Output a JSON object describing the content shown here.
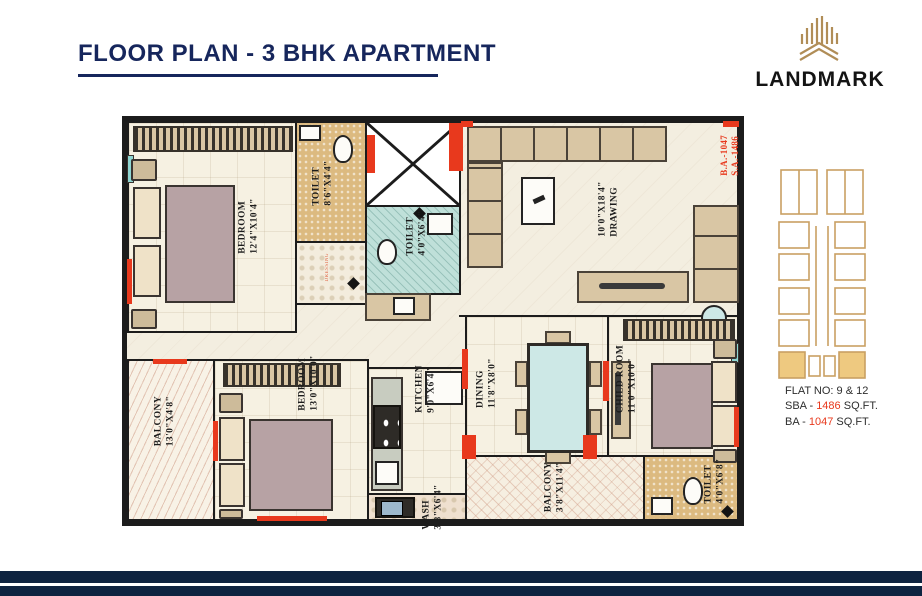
{
  "header": {
    "title": "FLOOR PLAN - 3 BHK APARTMENT"
  },
  "brand": {
    "name": "LANDMARK"
  },
  "plan": {
    "rooms": {
      "bedroom1": {
        "name": "BEDROOM",
        "dim": "12'4\"X10'4\""
      },
      "toilet1": {
        "name": "TOILET",
        "dim": "8'6\"X4'4\""
      },
      "toilet2": {
        "name": "TOILET",
        "dim": "4'0\"X6'4\""
      },
      "drawing": {
        "name": "DRAWING",
        "dim": "10'0\"X18'4\""
      },
      "balcony1": {
        "name": "BALCONY",
        "dim": "13'0\"X4'8\""
      },
      "bedroom2": {
        "name": "BEDROOM",
        "dim": "13'0\"X10'0\""
      },
      "kitchen": {
        "name": "KITCHEN",
        "dim": "9'0\"X6'4\""
      },
      "dining": {
        "name": "DINING",
        "dim": "11'8\"X8'0\""
      },
      "childroom": {
        "name": "CHILD ROOM",
        "dim": "11'0\"X10'0\""
      },
      "wash": {
        "name": "WASH",
        "dim": "3'8\"X6'4\""
      },
      "balcony2": {
        "name": "BALCONY",
        "dim": "3'8\"X11'4\""
      },
      "toilet3": {
        "name": "TOILET",
        "dim": "4'0\"X6'8\""
      }
    },
    "annotations": {
      "ba": "B.A.-1047",
      "sa": "S.A.-1486",
      "dress": "DRESSING"
    }
  },
  "keyplan": {
    "flat_line": "FLAT NO: 9 & 12",
    "sba_prefix": "SBA - ",
    "sba_value": "1486",
    "sba_suffix": " SQ.FT.",
    "ba_prefix": "BA - ",
    "ba_value": "1047",
    "ba_suffix": "  SQ.FT."
  },
  "colors": {
    "navy": "#16265c",
    "accent": "#e8391d",
    "gold": "#b08d57",
    "keyplan_fill": "#eec980"
  }
}
